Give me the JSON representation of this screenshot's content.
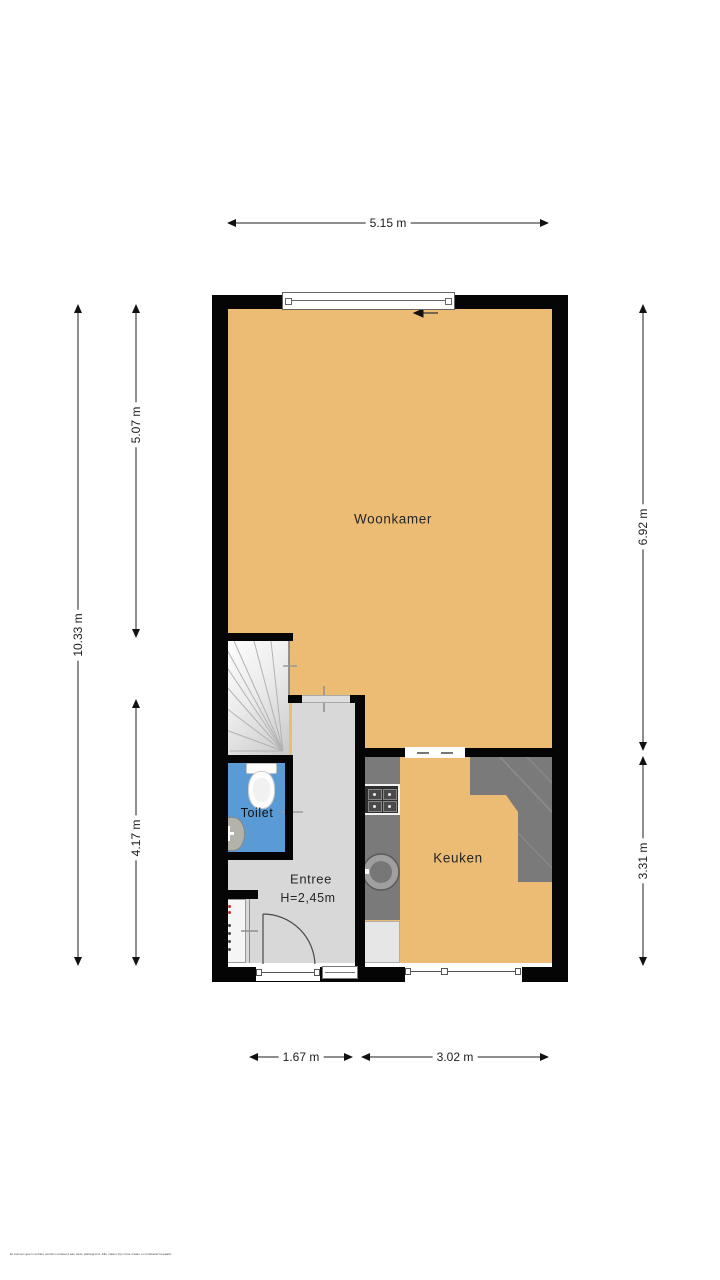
{
  "rooms": {
    "woonkamer": {
      "label": "Woonkamer"
    },
    "keuken": {
      "label": "Keuken"
    },
    "toilet": {
      "label": "Toilet"
    },
    "entree": {
      "label": "Entree",
      "ceiling_height": "H=2,45m"
    }
  },
  "dimensions": {
    "top_width": "5.15 m",
    "left_total_height": "10.33 m",
    "left_upper_height": "5.07 m",
    "left_lower_height": "4.17 m",
    "right_upper_height": "6.92 m",
    "right_lower_height": "3.31 m",
    "bottom_left_width": "1.67 m",
    "bottom_right_width": "3.02 m"
  },
  "footer": {
    "disclaimer": "Er kunnen geen rechten worden ontleend aan deze plattegrond. Alle maten zijn circa maten en indicatief bepaald."
  },
  "colors": {
    "floor_orange": "#ecbc74",
    "floor_gray": "#d8d8d8",
    "toilet_blue": "#5b9bd5",
    "counter_gray": "#7a7a7a",
    "wall_black": "#050505"
  }
}
